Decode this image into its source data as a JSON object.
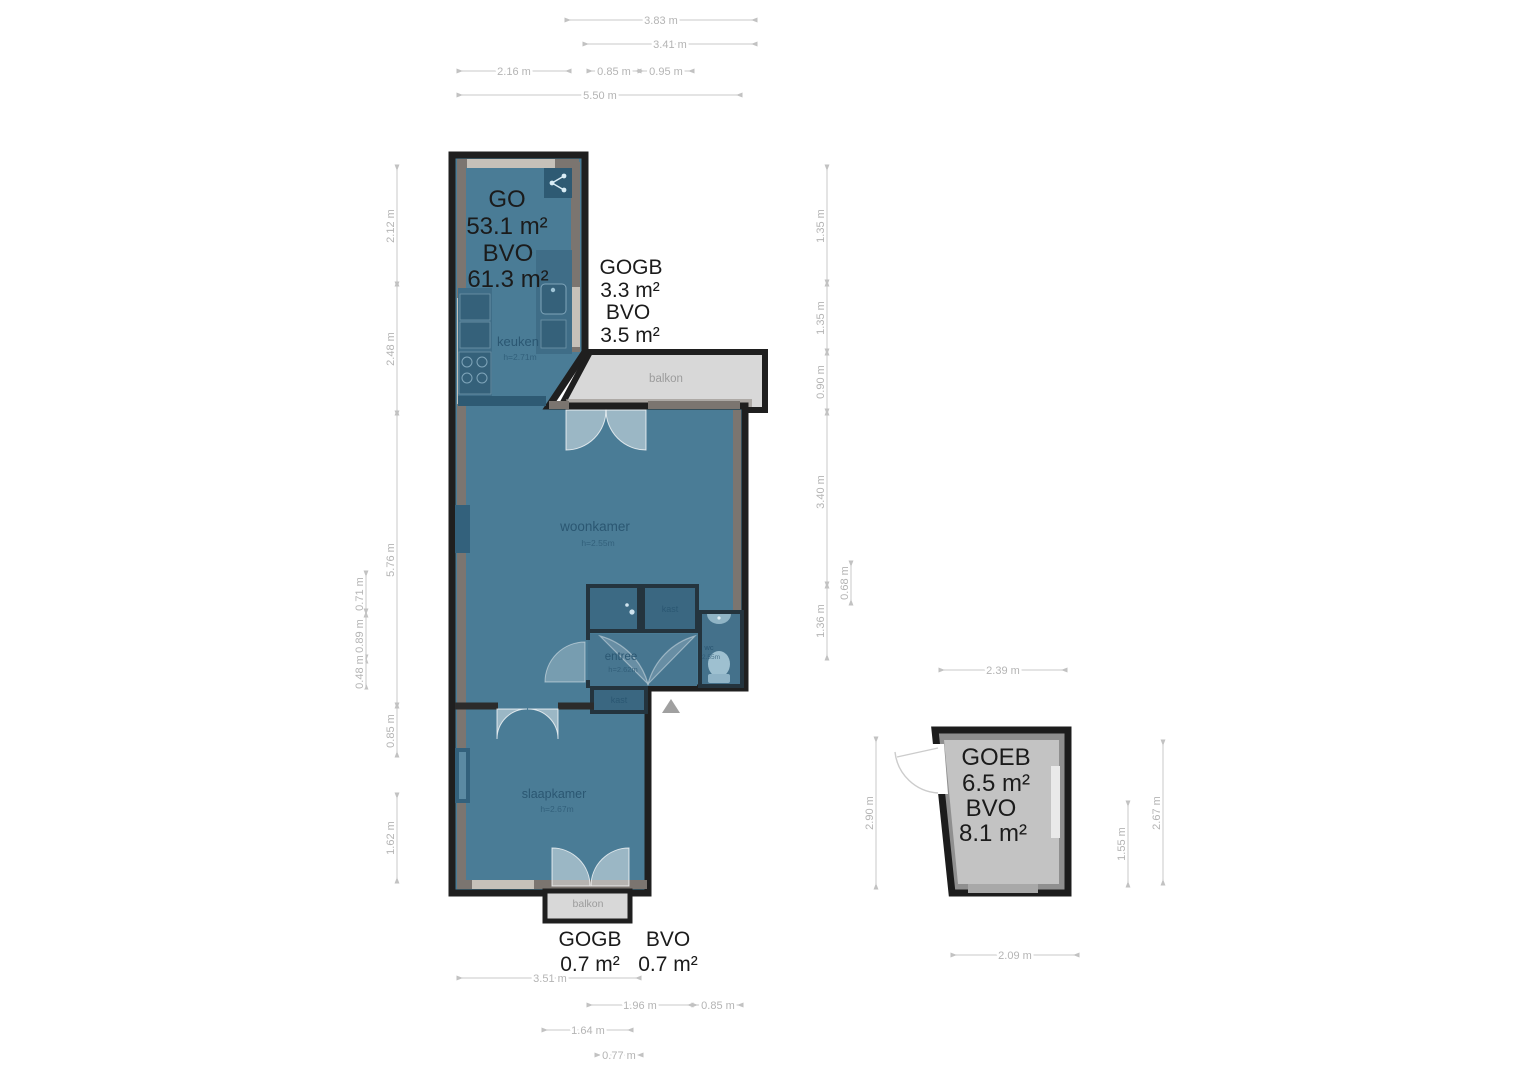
{
  "plan_type": "floorplan",
  "areas": {
    "main": {
      "l1": "GO",
      "l2": "53.1 m²",
      "l3": "BVO",
      "l4": "61.3 m²"
    },
    "balcony_top": {
      "l1": "GOGB",
      "l2": "3.3 m²",
      "l3": "BVO",
      "l4": "3.5 m²"
    },
    "balcony_bottom": {
      "l1": "GOGB",
      "l2": "0.7 m²",
      "l3": "BVO",
      "l4": "0.7 m²"
    },
    "storage": {
      "l1": "GOEB",
      "l2": "6.5 m²",
      "l3": "BVO",
      "l4": "8.1 m²"
    }
  },
  "rooms": {
    "keuken": {
      "name": "keuken",
      "h": "h=2.71m"
    },
    "woonkamer": {
      "name": "woonkamer",
      "h": "h=2.55m"
    },
    "entree": {
      "name": "entree",
      "h": "h=2.62m"
    },
    "kast_upper": {
      "name": "kast"
    },
    "kast_lower": {
      "name": "kast"
    },
    "wc": {
      "name": "wc",
      "h": "2.55m"
    },
    "slaapkamer": {
      "name": "slaapkamer",
      "h": "h=2.67m"
    },
    "balkon_top": {
      "name": "balkon"
    },
    "balkon_bottom": {
      "name": "balkon"
    }
  },
  "dims": {
    "top": [
      "3.83 m",
      "3.41 m",
      "2.16 m",
      "0.85 m",
      "0.95 m",
      "5.50 m"
    ],
    "left": [
      "2.12 m",
      "2.48 m",
      "5.76 m",
      "0.85 m",
      "1.62 m",
      "0.71 m",
      "0.89 m",
      "0.48 m"
    ],
    "right": [
      "1.35 m",
      "1.35 m",
      "0.90 m",
      "3.40 m",
      "1.36 m",
      "0.68 m"
    ],
    "bottom": [
      "3.51 m",
      "1.96 m",
      "0.85 m",
      "1.64 m",
      "0.77 m"
    ],
    "storage": [
      "2.39 m",
      "2.90 m",
      "1.55 m",
      "2.67 m",
      "2.09 m"
    ]
  },
  "colors": {
    "room_fill": "#4a7c96",
    "room_dark": "#3a6781",
    "wall": "#1f1f1f",
    "wall_lining": "#7b7570",
    "window": "#c6c1b9",
    "balcony_fill": "#d8d8d8",
    "storage_fill": "#c3c3c3",
    "dim_text": "#b4b4b4",
    "area_text": "#1b1b1b",
    "room_text": "#2b5772"
  }
}
